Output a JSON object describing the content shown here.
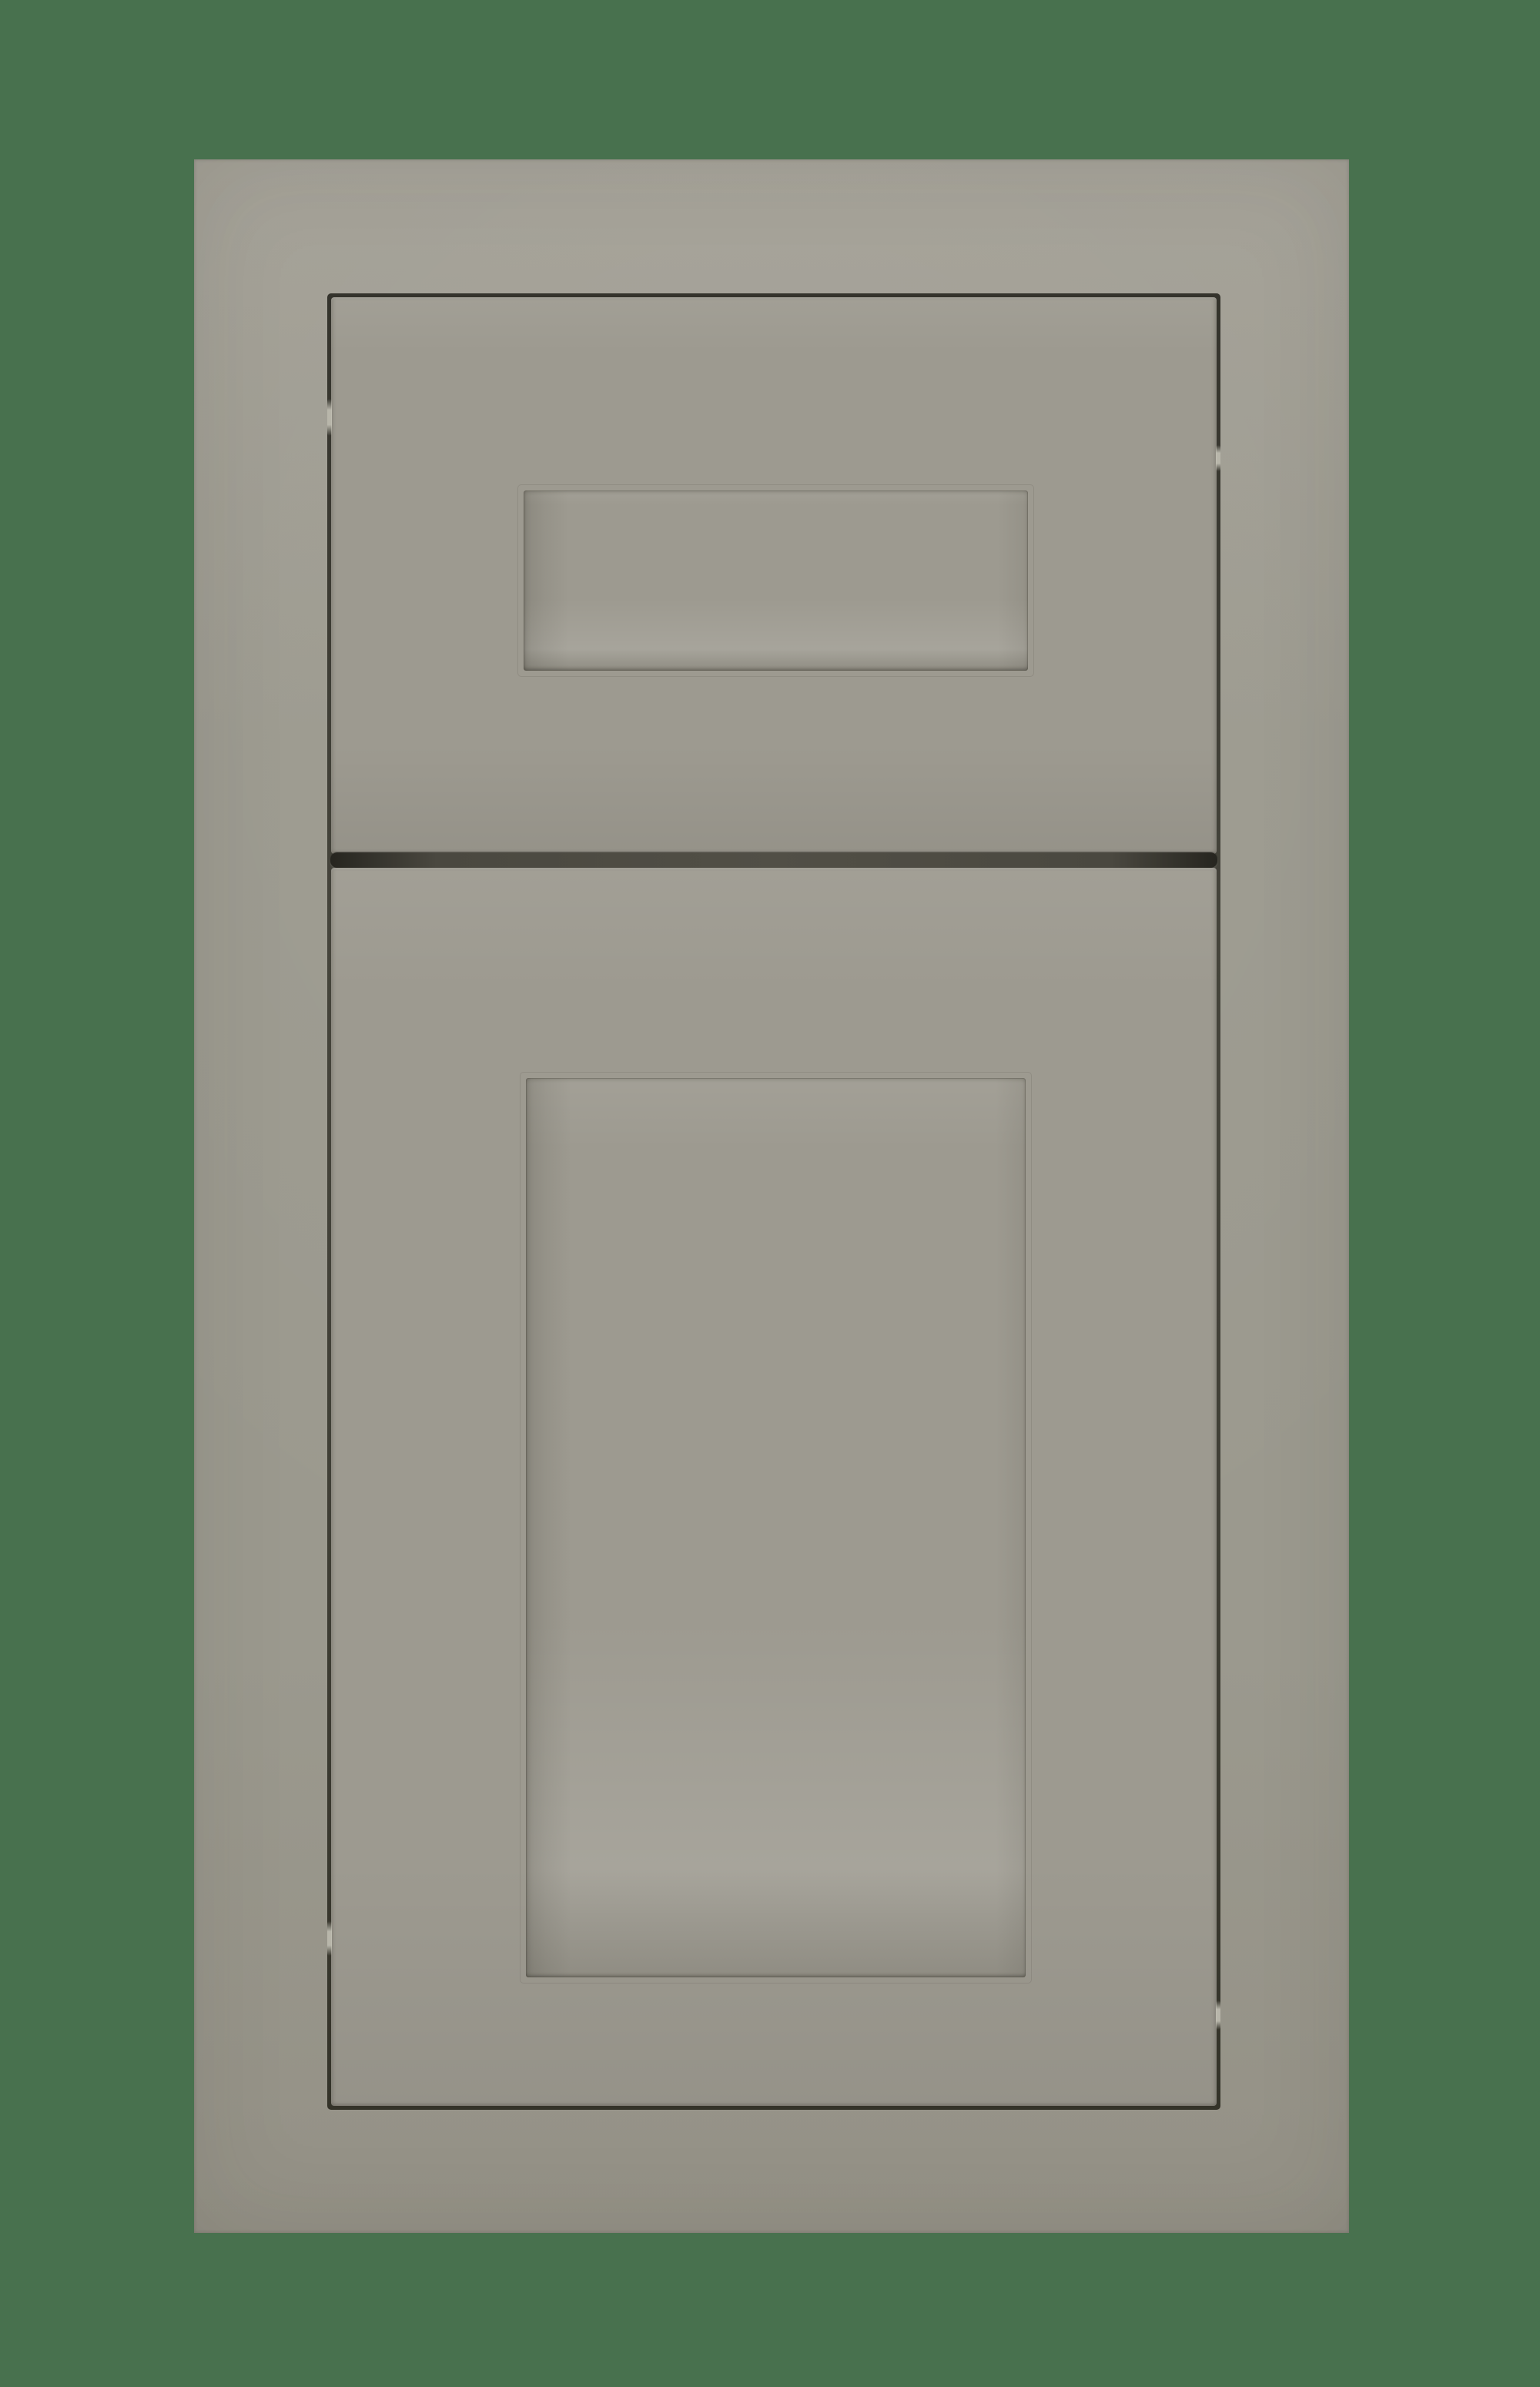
{
  "meta": {
    "alt": "Greige painted cabinet sample with an inset recessed-panel drawer front above a matching inset recessed-panel cabinet door, photographed on a dark green background"
  },
  "colors": {
    "bg": "#48714e",
    "cabinet": "#9b998e",
    "cabinet_light": "#a4a197",
    "cabinet_dark": "#949186",
    "front": "#9d9a90",
    "gap": "#3c3b33",
    "gap_mid": "#4a4840",
    "glint": "#c6c4b8",
    "line": "#55534a"
  }
}
